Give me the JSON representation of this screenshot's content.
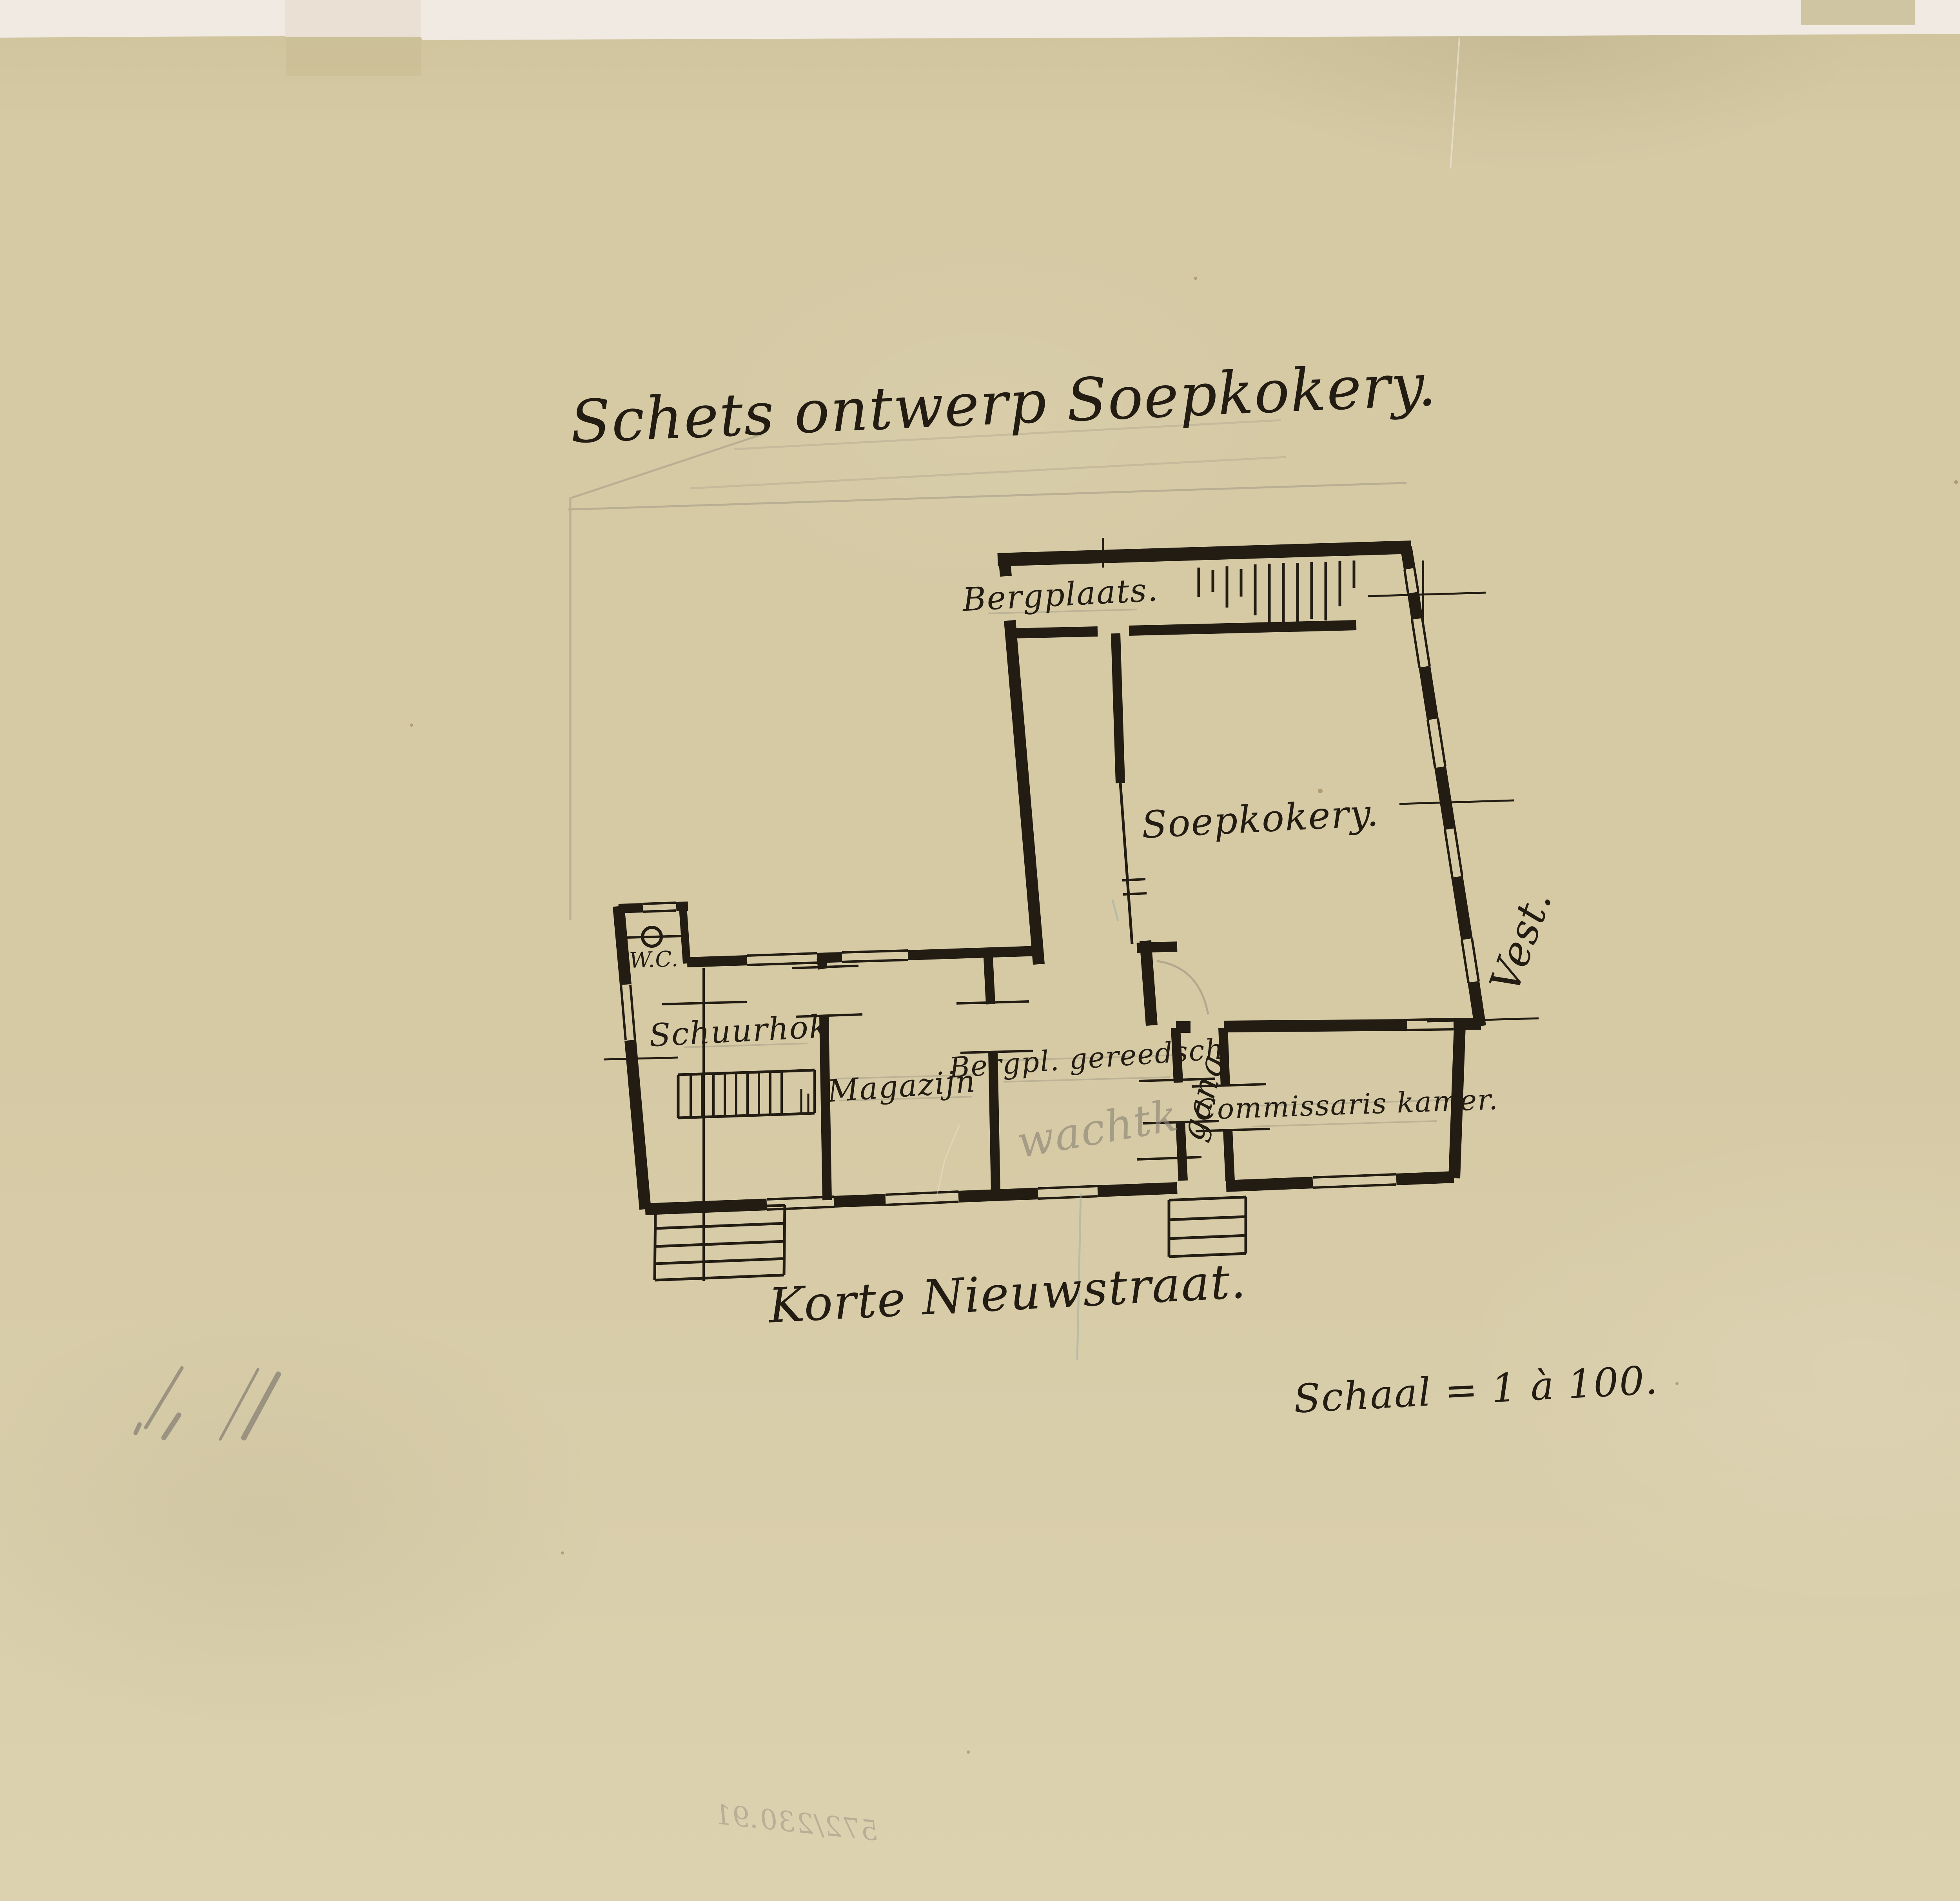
{
  "artwork": {
    "title": "Schets ontwerp Soepkokery.",
    "street": "Korte Nieuwstraat.",
    "scale": "Schaal = 1 à 100.",
    "side": "Vest.",
    "verso_number": "572/230.91",
    "medium": "ink and pencil floor plan on aged tracing paper"
  },
  "rooms": {
    "bergplaats": "Bergplaats.",
    "soepkokery": "Soepkokery.",
    "wc": "W.C.",
    "schuurhok": "Schuurhok",
    "magazijn": "Magazijn",
    "bergpl_gereedschap": "Bergpl. gereedsch",
    "wacht_pencil": "wachtk",
    "gang": "gang",
    "commissaris": "Commissaris kamer."
  },
  "colors": {
    "scan_bg": "#f0eae2",
    "paper": "#d6caa5",
    "paper_dark": "#cfc39c",
    "paper_light": "#dcd2b0",
    "ink": "#221c13",
    "pencil": "#8d8678",
    "blue_pencil": "#9aaba8",
    "stain": "#8a6f3f",
    "patch_light": "#e9dfd3",
    "patch_dark": "#c8bb92"
  }
}
